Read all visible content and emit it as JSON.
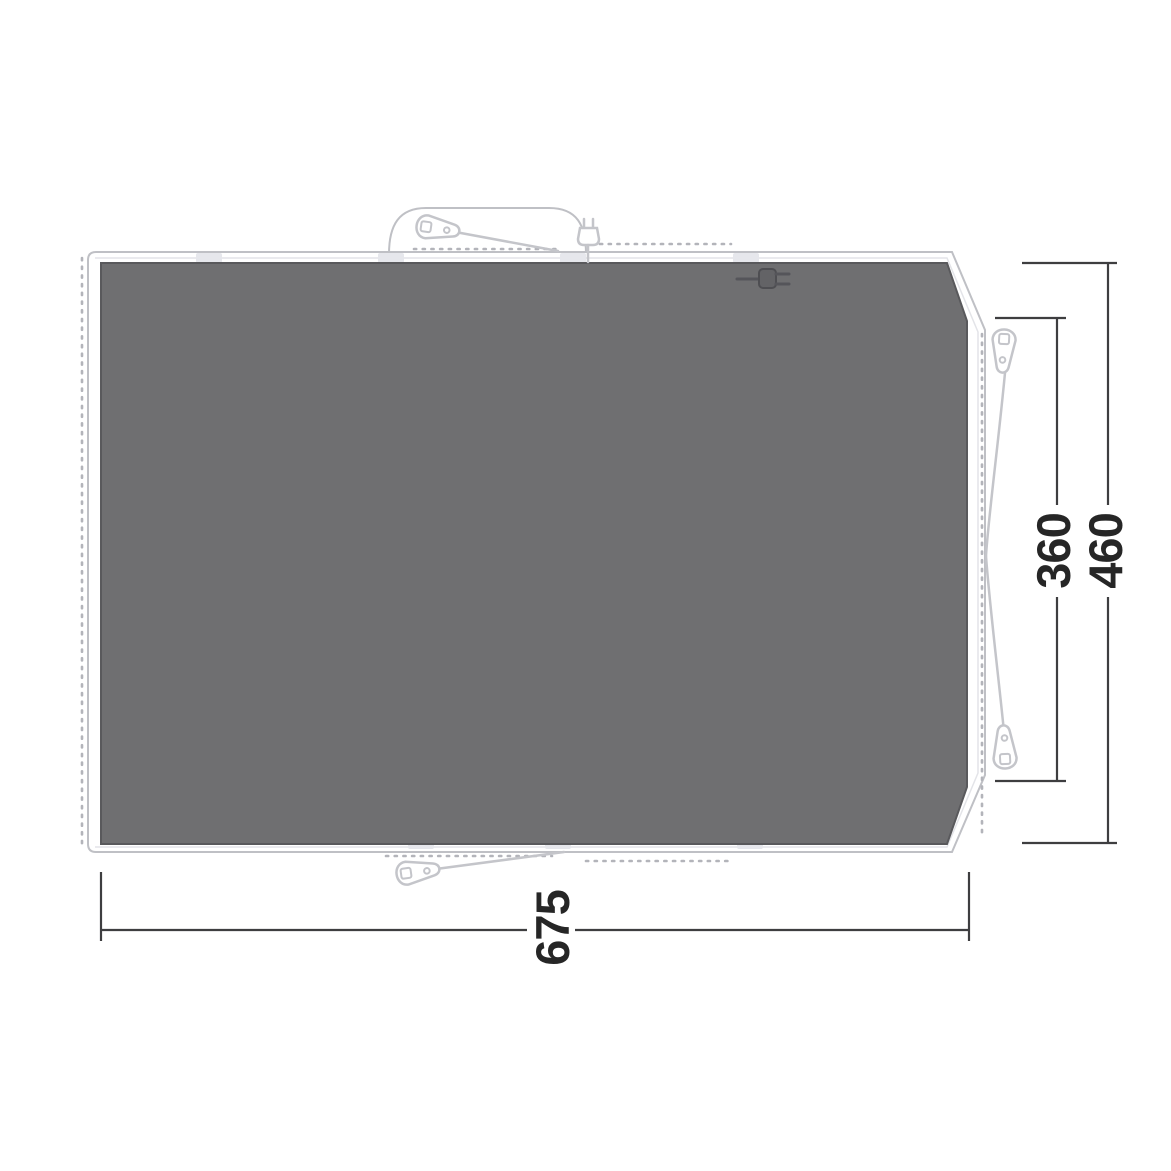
{
  "diagram": {
    "name": "Tent footprint / groundsheet floor plan with dimensions",
    "dimensions": {
      "width": "675",
      "inner_depth": "360",
      "outer_depth": "460"
    },
    "colors": {
      "background": "#ffffff",
      "mat_fill": "#6f6f71",
      "mat_stroke": "#59595c",
      "outline_stroke": "#bfc0c5",
      "dotted_seam": "#b3b4ba",
      "hardware_stroke": "#c4c5ca",
      "dark_plug": "#636366",
      "dimension_line": "#3e3e40",
      "label_text": "#262626"
    },
    "icons": [
      "tent-peg-icon",
      "guy-line",
      "power-plug-icon",
      "power-inlet-plug-icon",
      "door-canopy-outline"
    ]
  }
}
